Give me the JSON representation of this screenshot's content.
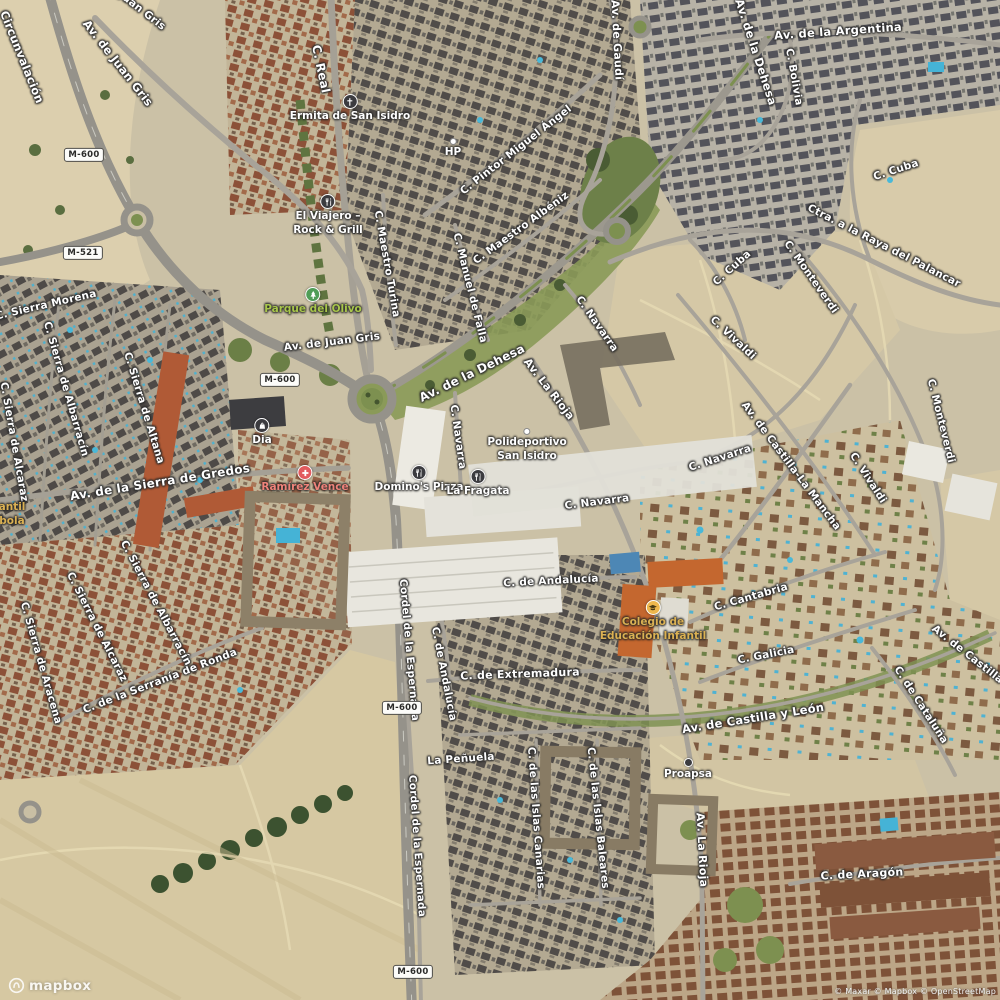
{
  "map": {
    "logo": "mapbox",
    "attribution": "© Maxar © Mapbox © OpenStreetMap",
    "colors": {
      "road_label": "#ffffff",
      "park_label": "#a8c64b",
      "school_label": "#dbb153",
      "health_label": "#ef837a",
      "poi_icon_dark": "#3b3b3f",
      "poi_icon_park": "#4f9d57",
      "poi_icon_school": "#edb74d",
      "poi_icon_health": "#e25b5e",
      "shield_bg": "#fcfcf9",
      "shield_text": "#2b2b29"
    },
    "shields": [
      {
        "t": "M-600",
        "x": 84,
        "y": 155
      },
      {
        "t": "M-521",
        "x": 83,
        "y": 253
      },
      {
        "t": "M-600",
        "x": 280,
        "y": 380
      },
      {
        "t": "M-600",
        "x": 402,
        "y": 708
      },
      {
        "t": "M-600",
        "x": 413,
        "y": 972
      }
    ],
    "road_labels": [
      {
        "t": "Circunvalación",
        "x": 22,
        "y": 57,
        "r": 68,
        "s": 11.5
      },
      {
        "t": "C. Juan Gris",
        "x": 136,
        "y": 6,
        "r": 38
      },
      {
        "t": "Av. de Juan Gris",
        "x": 118,
        "y": 63,
        "r": 52,
        "s": 11.5
      },
      {
        "t": "C. Real",
        "x": 321,
        "y": 69,
        "r": 78,
        "s": 12
      },
      {
        "t": "C. Pintor Miguel Ángel",
        "x": 516,
        "y": 150,
        "r": -38
      },
      {
        "t": "Av. de Gaudí",
        "x": 617,
        "y": 40,
        "r": 87,
        "s": 11
      },
      {
        "t": "Av. de la Dehesa",
        "x": 756,
        "y": 52,
        "r": 72,
        "s": 11.5
      },
      {
        "t": "Av. de la Argentina",
        "x": 838,
        "y": 31,
        "r": -4,
        "s": 11.5
      },
      {
        "t": "C. Bolivia",
        "x": 794,
        "y": 77,
        "r": 80
      },
      {
        "t": "C. Cuba",
        "x": 896,
        "y": 170,
        "r": -18
      },
      {
        "t": "Ctra. a la Raya del Palancar",
        "x": 884,
        "y": 246,
        "r": 27
      },
      {
        "t": "C. Cuba",
        "x": 732,
        "y": 268,
        "r": -42
      },
      {
        "t": "C. Monteverdi",
        "x": 811,
        "y": 277,
        "r": 55
      },
      {
        "t": "C. Maestro Turina",
        "x": 387,
        "y": 264,
        "r": 80
      },
      {
        "t": "C. Maestro Albéniz",
        "x": 521,
        "y": 228,
        "r": -36
      },
      {
        "t": "C. Manuel de Falla",
        "x": 470,
        "y": 288,
        "r": 76
      },
      {
        "t": "C. Sierra Morena",
        "x": 46,
        "y": 305,
        "r": -13
      },
      {
        "t": "C. Sierra de Albarracín",
        "x": 66,
        "y": 389,
        "r": 74
      },
      {
        "t": "C. Sierra de Alcaraz",
        "x": 14,
        "y": 442,
        "r": 80
      },
      {
        "t": "C. Sierra de Altana",
        "x": 144,
        "y": 408,
        "r": 73
      },
      {
        "t": "Av. de la Sierra de Gredos",
        "x": 160,
        "y": 482,
        "r": -9,
        "s": 12
      },
      {
        "t": "Av. de Juan Gris",
        "x": 332,
        "y": 342,
        "r": -7
      },
      {
        "t": "Av. de la Dehesa",
        "x": 472,
        "y": 373,
        "r": -26,
        "s": 12
      },
      {
        "t": "Av. La Rioja",
        "x": 549,
        "y": 389,
        "r": 52,
        "s": 11
      },
      {
        "t": "C. Navarra",
        "x": 458,
        "y": 437,
        "r": 82
      },
      {
        "t": "C. Navarra",
        "x": 597,
        "y": 324,
        "r": 55
      },
      {
        "t": "C. Navarra",
        "x": 597,
        "y": 502,
        "r": -7
      },
      {
        "t": "C. Navarra",
        "x": 720,
        "y": 458,
        "r": -18
      },
      {
        "t": "C. Vivaldi",
        "x": 733,
        "y": 338,
        "r": 43
      },
      {
        "t": "C. Monteverdi",
        "x": 941,
        "y": 421,
        "r": 76
      },
      {
        "t": "Av. de Castilla-La Mancha",
        "x": 791,
        "y": 466,
        "r": 53
      },
      {
        "t": "C. Vivaldi",
        "x": 868,
        "y": 478,
        "r": 57
      },
      {
        "t": "C. de Andalucía",
        "x": 551,
        "y": 581,
        "r": -3
      },
      {
        "t": "C. de Andalucía",
        "x": 444,
        "y": 674,
        "r": 79
      },
      {
        "t": "C. de Extremadura",
        "x": 520,
        "y": 674,
        "r": -2,
        "s": 11
      },
      {
        "t": "Cordel de la Espernada",
        "x": 409,
        "y": 650,
        "r": 85
      },
      {
        "t": "Cordel de la Espernada",
        "x": 417,
        "y": 846,
        "r": 86
      },
      {
        "t": "La Peñuela",
        "x": 461,
        "y": 759,
        "r": -4
      },
      {
        "t": "C. de las Islas Canarias",
        "x": 536,
        "y": 818,
        "r": 86
      },
      {
        "t": "C. de las Islas Baleares",
        "x": 598,
        "y": 818,
        "r": 84
      },
      {
        "t": "Av. de Castilla y León",
        "x": 753,
        "y": 718,
        "r": -9,
        "s": 11.5
      },
      {
        "t": "Av. La Rioja",
        "x": 702,
        "y": 850,
        "r": 87,
        "s": 11
      },
      {
        "t": "C. de Aragón",
        "x": 862,
        "y": 874,
        "r": -3,
        "s": 11
      },
      {
        "t": "C. Cantabria",
        "x": 751,
        "y": 597,
        "r": -16
      },
      {
        "t": "C. Galicia",
        "x": 766,
        "y": 655,
        "r": -11
      },
      {
        "t": "C. de Cataluña",
        "x": 921,
        "y": 705,
        "r": 57
      },
      {
        "t": "Av. de Castilla y León",
        "x": 985,
        "y": 668,
        "r": 38
      },
      {
        "t": "C. de la Serranía de Ronda",
        "x": 160,
        "y": 681,
        "r": -21
      },
      {
        "t": "C. Sierra de Aracena",
        "x": 41,
        "y": 663,
        "r": 74
      },
      {
        "t": "C. Sierra de Alcaraz",
        "x": 97,
        "y": 627,
        "r": 63
      },
      {
        "t": "C. Sierra de Albarracín",
        "x": 156,
        "y": 603,
        "r": 62
      }
    ],
    "poi_labels": [
      {
        "lines": [
          "Ermita de San Isidro"
        ],
        "x": 350,
        "iy": 102,
        "icon": "church-icon",
        "bg": "#3b3b3f",
        "color": "#ffffff"
      },
      {
        "lines": [
          "HP"
        ],
        "x": 453,
        "iy": 146,
        "icon": "dot-white-icon",
        "color": "#ffffff"
      },
      {
        "lines": [
          "El Viajero –",
          "Rock & Grill"
        ],
        "x": 328,
        "iy": 202,
        "icon": "restaurant-icon",
        "bg": "#3b3b3f",
        "color": "#ffffff"
      },
      {
        "lines": [
          "Parque del Olivo"
        ],
        "x": 313,
        "iy": 295,
        "icon": "park-icon",
        "bg": "#4f9d57",
        "color": "#a8c64b"
      },
      {
        "lines": [
          "Dia"
        ],
        "x": 262,
        "iy": 426,
        "icon": "cart-icon",
        "bg": "#3b3b3f",
        "color": "#ffffff"
      },
      {
        "lines": [
          "Ramírez Vence"
        ],
        "x": 305,
        "iy": 473,
        "icon": "health-icon",
        "bg": "#e25b5e",
        "color": "#ef837a"
      },
      {
        "lines": [
          "Domino's Pizza"
        ],
        "x": 419,
        "iy": 473,
        "icon": "restaurant-icon",
        "bg": "#3b3b3f",
        "color": "#ffffff"
      },
      {
        "lines": [
          "La Fragata"
        ],
        "x": 478,
        "iy": 477,
        "icon": "restaurant-icon",
        "bg": "#3b3b3f",
        "color": "#ffffff"
      },
      {
        "lines": [
          "Polideportivo",
          "San Isidro"
        ],
        "x": 527,
        "iy": 436,
        "icon": "dot-white-icon",
        "color": "#ffffff"
      },
      {
        "lines": [
          "Colegio de",
          "Educación Infantil"
        ],
        "x": 653,
        "iy": 608,
        "icon": "school-icon",
        "bg": "#edb74d",
        "glyph": "#4a3a14",
        "color": "#dbb153"
      },
      {
        "lines": [
          "Proapsa"
        ],
        "x": 688,
        "iy": 766,
        "icon": "dot-dark-icon",
        "color": "#ffffff"
      },
      {
        "lines": [
          "antil",
          "bola"
        ],
        "x": 12,
        "iy": 509,
        "icon": "none",
        "color": "#dbb153"
      }
    ]
  }
}
